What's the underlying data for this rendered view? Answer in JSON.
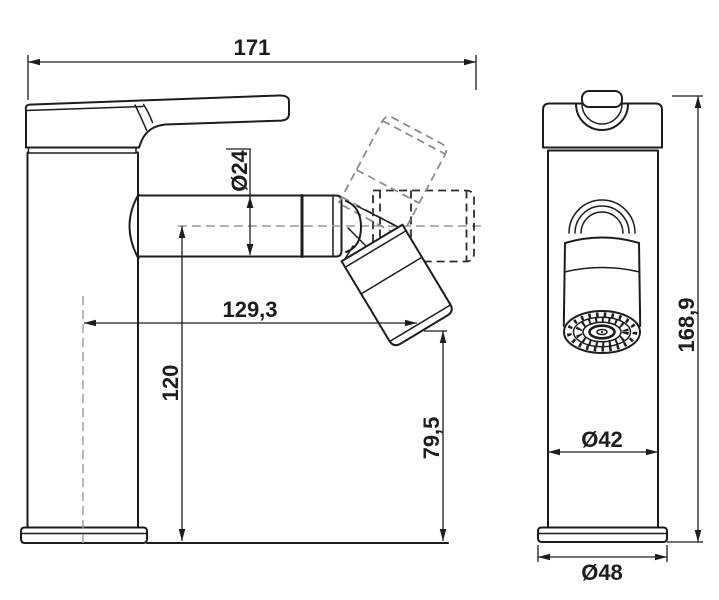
{
  "dimensions": {
    "overall_length": "171",
    "spout_diameter": "Ø24",
    "spout_reach": "129,3",
    "spout_center_height": "120",
    "outlet_height": "79,5",
    "total_height": "168,9",
    "body_diameter": "Ø42",
    "base_diameter": "Ø48"
  },
  "colors": {
    "line": "#1d1d1d",
    "ghost_position_dark": "#2b2b2b",
    "ghost_position_light": "#8c8c8c",
    "centerline": "#999999",
    "background": "#ffffff"
  }
}
